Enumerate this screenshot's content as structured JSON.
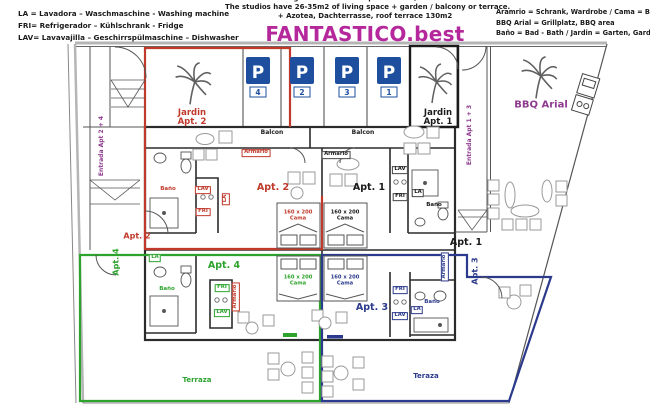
{
  "header": {
    "legend_left": {
      "line1": "LA = Lavadora – Waschmaschine - Washing machine",
      "line2": "FRI= Refrigerador – Kühlschrank - Fridge",
      "line3": "LAV= Lavavajilla – Geschirrspülmaschine – Dishwasher"
    },
    "center": {
      "line1": "Die Studios verfügen über 26-35m2 plus Balkon, Garten oder Terrasse.",
      "line2": "The studios have 26-35m2 of living space + garden / balcony or terrace.",
      "line3": "+ Azotea, Dachterrasse, roof terrace 130m2",
      "brand": "FANTASTICO.best"
    },
    "legend_right": {
      "line1": "Aramrio = Schrank, Wardrobe / Cama = Bett - Bed",
      "line2": "BBQ Arial = Grillplatz, BBQ area",
      "line3": "Baño = Bad -  Bath / Jardin = Garten, Garden"
    }
  },
  "parking": {
    "letter": "P",
    "stall1": "4",
    "stall2": "2",
    "stall3": "3",
    "stall4": "1"
  },
  "plan": {
    "bbq_area": "BBQ Arial",
    "entrada_left": "Entrada Apt 2 + 4",
    "entrada_right": "Entrada Apt 1 + 3",
    "jardin2": {
      "l1": "Jardin",
      "l2": "Apt. 2"
    },
    "jardin1": {
      "l1": "Jardin",
      "l2": "Apt. 1"
    },
    "apt1": {
      "name": "Apt. 1",
      "entry": "Apt. 1",
      "balcon": "Balcon",
      "armario": "Armario",
      "lav": "LAV",
      "fri": "FRI",
      "la": "LA",
      "bano": "Baño",
      "bed1": "160 x 200",
      "bed2": "Cama"
    },
    "apt2": {
      "name": "Apt. 2",
      "entry": "Apt. 2",
      "balcon": "Balcon",
      "armario": "Armario",
      "lav": "LAV",
      "fri": "FRI",
      "la": "LA",
      "bano": "Baño",
      "bed1": "160 x 200",
      "bed2": "Cama"
    },
    "apt3": {
      "name": "Apt. 3",
      "entry": "Apt. 3",
      "terraza": "Teraza",
      "armario": "Armario",
      "lav": "LAV",
      "fri": "FRI",
      "la": "LA",
      "bano": "Baño",
      "bed1": "160 x 200",
      "bed2": "Cama"
    },
    "apt4": {
      "name": "Apt. 4",
      "entry": "Apt. 4",
      "terraza": "Terraza",
      "armario": "Armario",
      "lav": "LAV",
      "fri": "FRI",
      "la": "LA",
      "bano": "Baño",
      "bed1": "160 x 200",
      "bed2": "Cama"
    }
  },
  "colors": {
    "apt1": "#1a1a1a",
    "apt2": "#c0392b",
    "apt3": "#2b3a8c",
    "apt4": "#2da32d",
    "brand_magenta": "#b4289c",
    "entrada_purple": "#8e3a8e",
    "parking_blue": "#1e4f9f"
  }
}
